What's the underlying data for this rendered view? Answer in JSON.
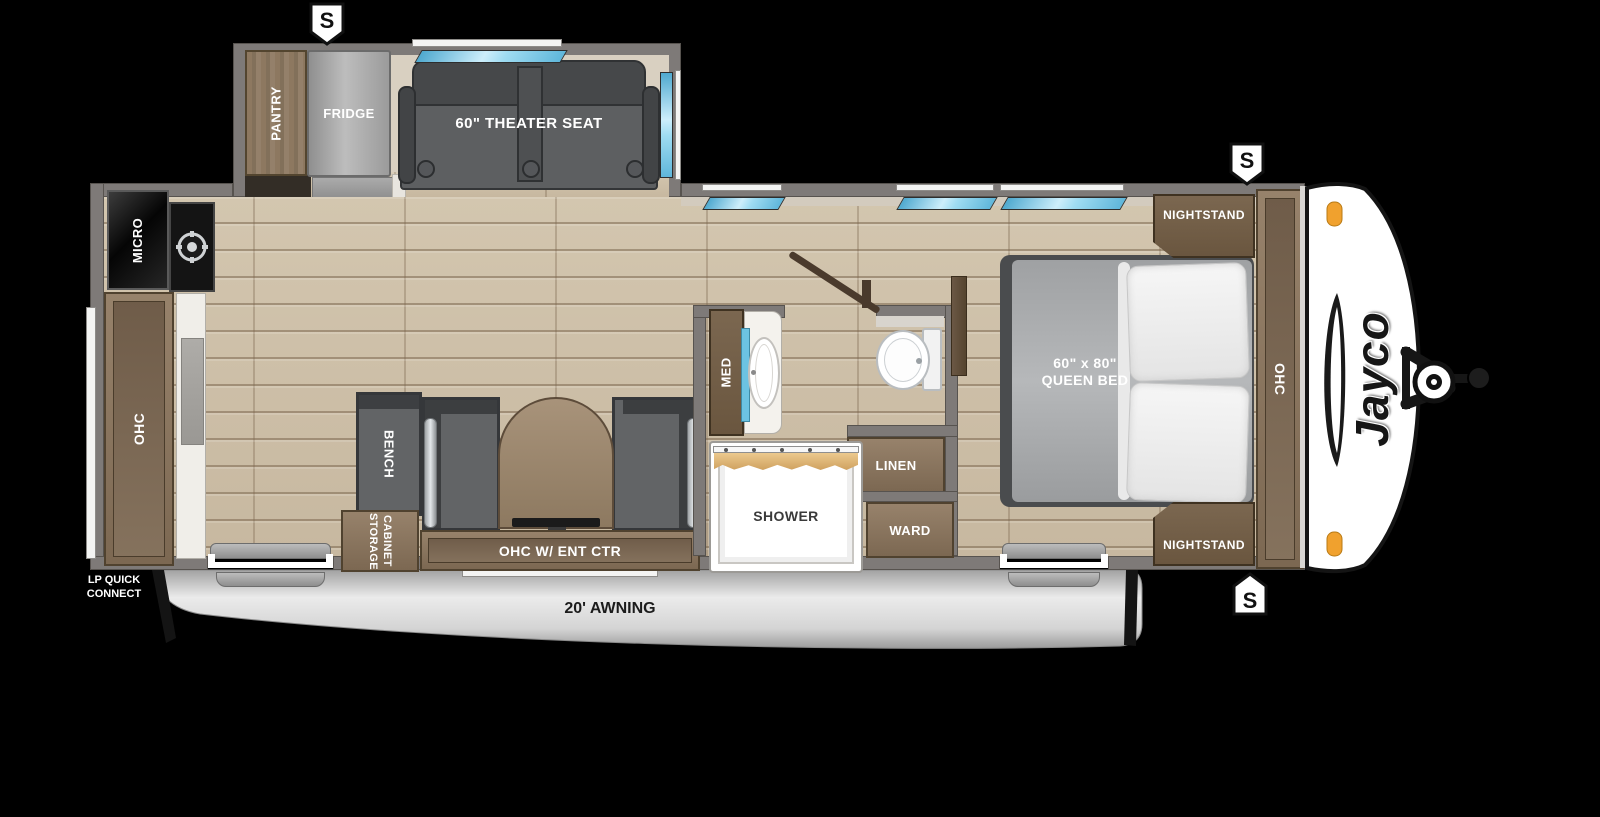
{
  "floorplan": {
    "brand": "Jayco",
    "slide_out": {
      "pantry": "PANTRY",
      "fridge": "FRIDGE",
      "theater_seat": "60\" THEATER SEAT"
    },
    "kitchen": {
      "micro": "MICRO",
      "ohc": "OHC"
    },
    "dinette": {
      "bench": "BENCH",
      "storage_cabinet": [
        "STORAGE",
        "CABINET"
      ],
      "ent_ctr": "OHC W/ ENT CTR"
    },
    "bathroom": {
      "med": "MED",
      "shower": "SHOWER",
      "linen": "LINEN",
      "ward": "WARD"
    },
    "bedroom": {
      "nightstand_top": "NIGHTSTAND",
      "nightstand_bottom": "NIGHTSTAND",
      "bed_size": "60\" x 80\"",
      "bed_name": "QUEEN BED",
      "ohc": "OHC"
    },
    "exterior": {
      "awning": "20' AWNING",
      "lp_quick_connect": [
        "LP QUICK",
        "CONNECT"
      ],
      "speaker_label": "S"
    },
    "colors": {
      "wall": "#7e7a78",
      "floor": "#cdbfa8",
      "wood": "#8d7860",
      "cushion": "#5f6163",
      "window_blue": "#8fd2ee",
      "awning_gray": "#d9d9d9",
      "marker_orange": "#f0a12e",
      "cap_white": "#ffffff",
      "background": "#000000"
    }
  }
}
